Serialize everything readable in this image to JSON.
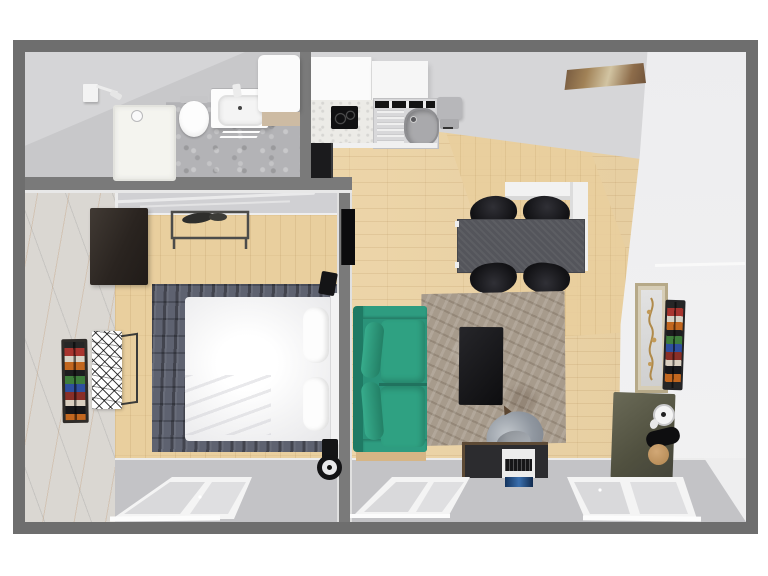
{
  "meta": {
    "title": "Apartment floor plan - 3D top-down render",
    "canvas": {
      "width": 768,
      "height": 576
    },
    "background": "#ffffff"
  },
  "palette": {
    "outer_wall": "#6e6e6e",
    "inner_wall": "#7a7a7a",
    "wall_face_light": "#d0d0d3",
    "wood_floor": "#ecd3a4",
    "concrete_floor": "#b3b3b6",
    "marble_accent_wall": "#dad7d2",
    "bedroom_rug": "#5e6270",
    "living_rug": "#a79b8c",
    "sofa_teal": "#2d9b7f",
    "dining_table_gray": "#54555b",
    "chair_black": "#17171a",
    "coffee_table_black": "#161616",
    "wardrobe_dark": "#2a2420",
    "olive_cabinet": "#57574a",
    "bed_white": "#f6f6f6",
    "window_frame": "#f4f4f4",
    "window_glass": "#d9d9db",
    "monitor_screen": "#2b4f86",
    "painting_brown": "#8a6a48",
    "sofa_base_wood": "#d6b585"
  },
  "rooms": {
    "bathroom": {
      "name": "Bathroom",
      "floor": "concrete",
      "items": [
        "shower tray with drain",
        "toilet",
        "washbasin vanity with faucet",
        "bath mat",
        "wall-mounted fixture",
        "tall white storage cabinet",
        "wood shelf strip"
      ]
    },
    "kitchen_dining": {
      "name": "Kitchen / Dining",
      "floor": "wood planks",
      "items": [
        "two upper cabinets",
        "induction hob",
        "stainless sink with drainboard",
        "countertop appliance",
        "tall black unit",
        "dark gray dining table",
        "four black chairs",
        "white L-shaped partition",
        "abstract wall painting"
      ]
    },
    "living_room": {
      "name": "Living room",
      "floor": "wood planks",
      "items": [
        "teal two-seat sofa with bolster pillows",
        "taupe area rug",
        "black coffee table",
        "gray desk chair",
        "desk with keyboard and monitor",
        "olive side cabinet",
        "desk fan",
        "framed wall art",
        "media spine shelf",
        "two perspective windows"
      ]
    },
    "bedroom": {
      "name": "Bedroom",
      "floor": "wood planks",
      "items": [
        "double bed with white duvet",
        "blue-gray rug",
        "dark wardrobe",
        "open clothes rack",
        "wall TV",
        "two black speakers",
        "wheel device",
        "wall-mounted book shelf",
        "mosaic console table",
        "marble accent wall",
        "perspective window"
      ]
    }
  },
  "windows": {
    "count": 3,
    "style": "two-pane, perspective-skewed, white frame with sill"
  }
}
